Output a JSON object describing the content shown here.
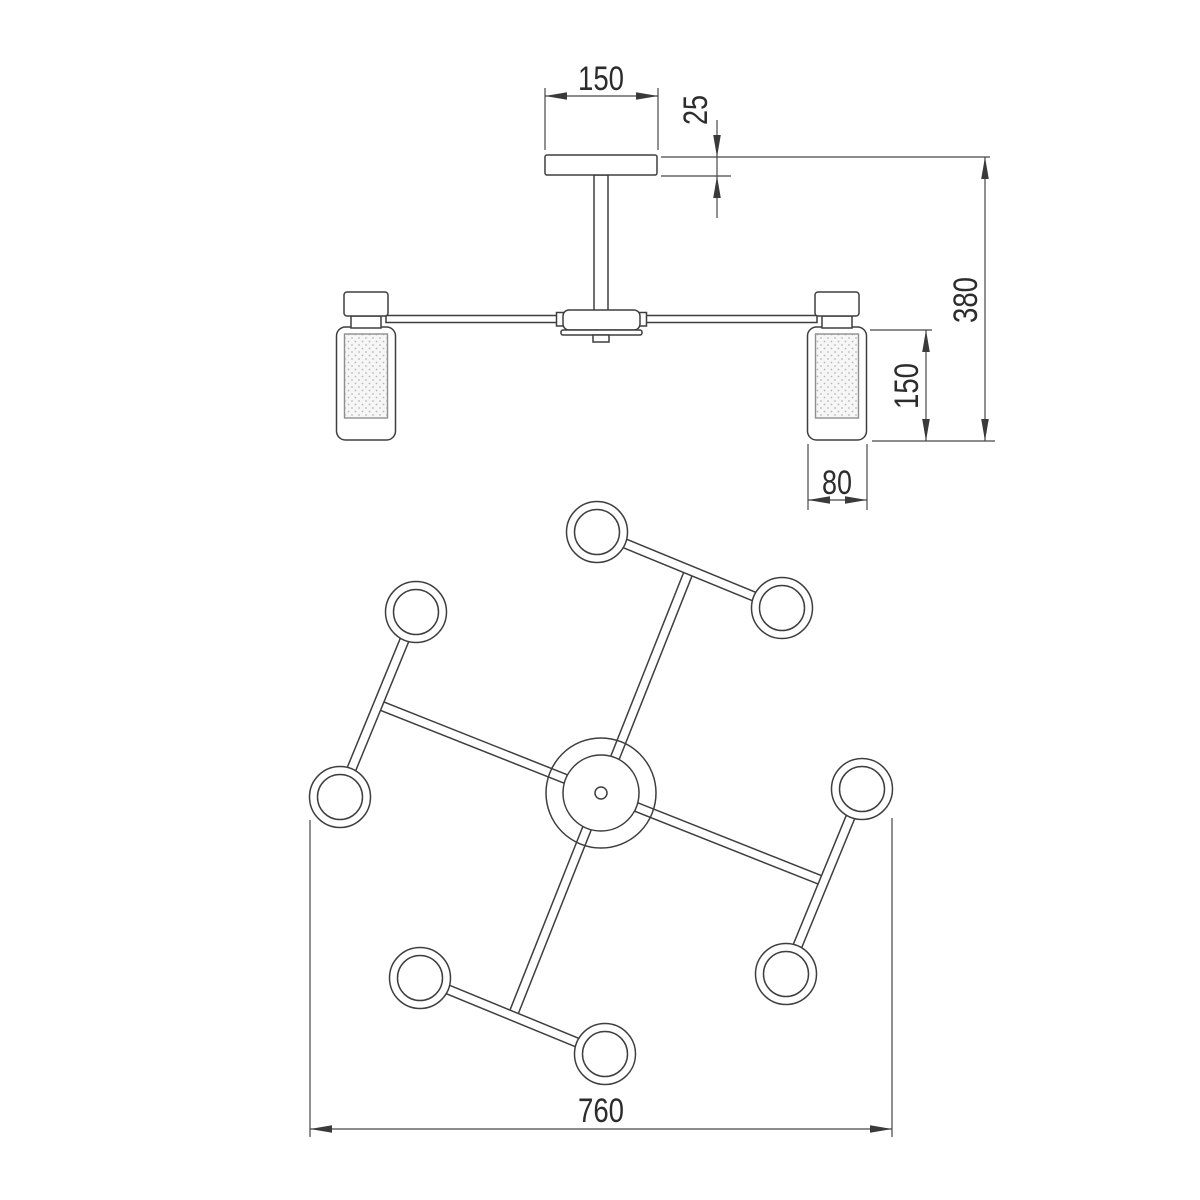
{
  "colors": {
    "background": "#ffffff",
    "outline": "#3e3e3e",
    "dimension_line": "#474747",
    "dimension_text": "#2c2c2c",
    "diffuser_fill": "#f6f6f6",
    "diffuser_dot": "#b9b9b9"
  },
  "side_view": {
    "dimensions": {
      "canopy_width": "150",
      "canopy_thickness": "25",
      "overall_height": "380",
      "shade_height": "150",
      "shade_diameter": "80"
    }
  },
  "plan_view": {
    "dimensions": {
      "overall_diameter": "760"
    }
  }
}
